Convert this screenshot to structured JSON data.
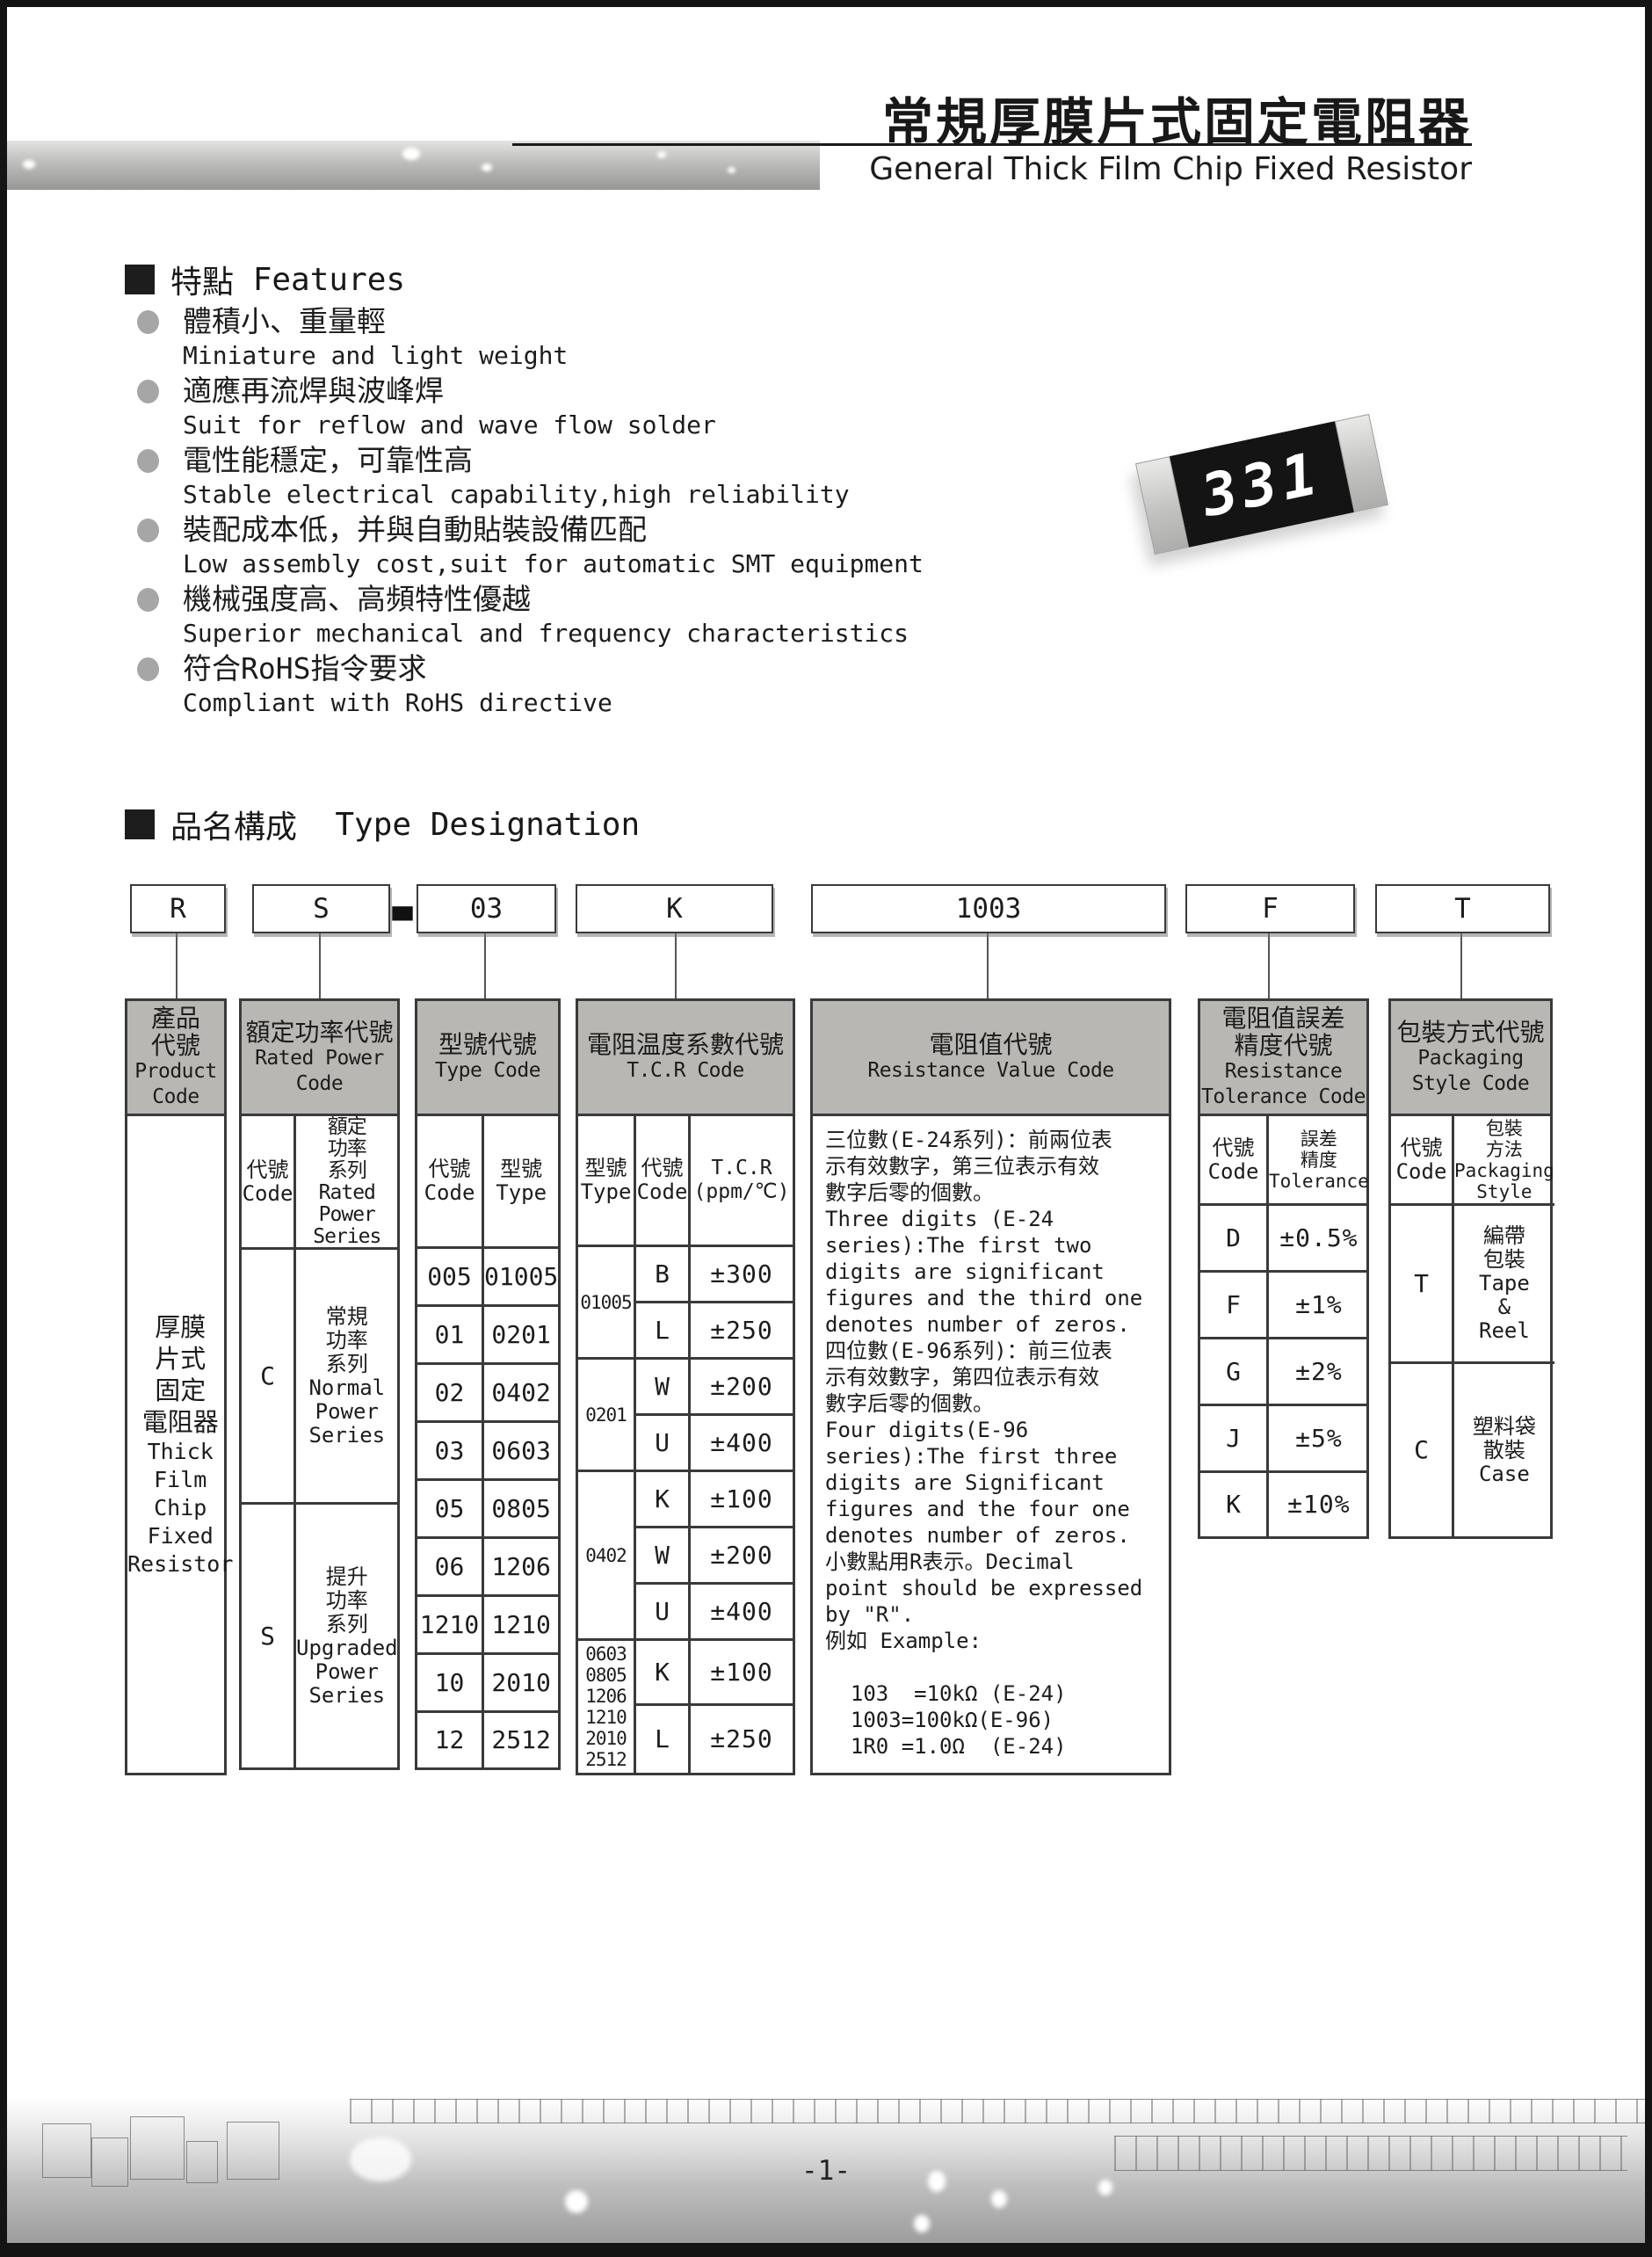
{
  "colors": {
    "header_fill": "#b8b7b3",
    "table_line": "#3a3a3a",
    "frame_black": "#141414",
    "bullet_gray": "#a6a6a6"
  },
  "header": {
    "title_cn": "常規厚膜片式固定電阻器",
    "title_en": "General Thick Film Chip Fixed Resistor"
  },
  "resistor_image": {
    "marking": "331"
  },
  "features": {
    "heading_cn": "特點",
    "heading_en": "Features",
    "items": [
      {
        "cn": "體積小、重量輕",
        "en": "Miniature and light weight"
      },
      {
        "cn": "適應再流焊與波峰焊",
        "en": "Suit for reflow and wave flow solder"
      },
      {
        "cn": "電性能穩定，可靠性高",
        "en": "Stable electrical capability,high reliability"
      },
      {
        "cn": "裝配成本低，并與自動貼裝設備匹配",
        "en": "Low assembly cost,suit for automatic SMT equipment"
      },
      {
        "cn": "機械强度高、高頻特性優越",
        "en": "Superior mechanical and frequency characteristics"
      },
      {
        "cn": "符合RoHS指令要求",
        "en": "Compliant with RoHS directive"
      }
    ]
  },
  "type_designation": {
    "heading_cn": "品名構成",
    "heading_en": "Type Designation",
    "codes": {
      "product": "R",
      "power": "S",
      "dash": "-",
      "type": "03",
      "tcr": "K",
      "resistance": "1003",
      "tolerance": "F",
      "packaging": "T"
    },
    "product_col": {
      "header_cn": "產品\n代號",
      "header_en": "Product\nCode",
      "body_cn": "厚膜\n片式\n固定\n電阻器",
      "body_en": "Thick\nFilm\nChip\nFixed\nResistor"
    },
    "power_col": {
      "header_cn": "額定功率代號",
      "header_en": "Rated Power\nCode",
      "sub_code": "代號\nCode",
      "sub_series": "額定\n功率\n系列\nRated\nPower\nSeries",
      "rows": [
        {
          "code": "C",
          "series": "常規\n功率\n系列\nNormal\nPower\nSeries"
        },
        {
          "code": "S",
          "series": "提升\n功率\n系列\nUpgraded\nPower\nSeries"
        }
      ]
    },
    "type_col": {
      "header_cn": "型號代號",
      "header_en": "Type Code",
      "sub_code": "代號\nCode",
      "sub_type": "型號\nType",
      "rows": [
        {
          "code": "005",
          "type": "01005"
        },
        {
          "code": "01",
          "type": "0201"
        },
        {
          "code": "02",
          "type": "0402"
        },
        {
          "code": "03",
          "type": "0603"
        },
        {
          "code": "05",
          "type": "0805"
        },
        {
          "code": "06",
          "type": "1206"
        },
        {
          "code": "1210",
          "type": "1210"
        },
        {
          "code": "10",
          "type": "2010"
        },
        {
          "code": "12",
          "type": "2512"
        }
      ]
    },
    "tcr_col": {
      "header_cn": "電阻温度系數代號",
      "header_en": "T.C.R Code",
      "sub_type": "型號\nType",
      "sub_code": "代號\nCode",
      "sub_tcr": "T.C.R\n(ppm/℃)",
      "groups": [
        {
          "type": "01005",
          "rows": [
            {
              "code": "B",
              "tcr": "±300"
            },
            {
              "code": "L",
              "tcr": "±250"
            }
          ]
        },
        {
          "type": "0201",
          "rows": [
            {
              "code": "W",
              "tcr": "±200"
            },
            {
              "code": "U",
              "tcr": "±400"
            }
          ]
        },
        {
          "type": "0402",
          "rows": [
            {
              "code": "K",
              "tcr": "±100"
            },
            {
              "code": "W",
              "tcr": "±200"
            },
            {
              "code": "U",
              "tcr": "±400"
            }
          ]
        },
        {
          "type": "0603\n0805\n1206\n1210\n2010\n2512",
          "rows": [
            {
              "code": "K",
              "tcr": "±100"
            },
            {
              "code": "L",
              "tcr": "±250"
            }
          ]
        }
      ]
    },
    "resistance_col": {
      "header_cn": "電阻值代號",
      "header_en": "Resistance Value Code",
      "body": "三位數(E-24系列)：前兩位表\n示有效數字，第三位表示有效\n數字后零的個數。\nThree digits (E-24\nseries):The first two\ndigits are significant\nfigures and the third one\ndenotes number of zeros.\n四位數(E-96系列)：前三位表\n示有效數字，第四位表示有效\n數字后零的個數。\nFour digits(E-96\nseries):The first three\ndigits are Significant\nfigures and the four one\ndenotes number of zeros.\n小數點用R表示。Decimal\npoint should be expressed\nby \"R\".\n例如 Example:\n\n  103  =10kΩ (E-24)\n  1003=100kΩ(E-96)\n  1R0 =1.0Ω  (E-24)"
    },
    "tolerance_col": {
      "header_cn": "電阻值誤差\n精度代號",
      "header_en": "Resistance\nTolerance Code",
      "sub_code": "代號\nCode",
      "sub_tol": "誤差\n精度\nTolerance",
      "rows": [
        {
          "code": "D",
          "tol": "±0.5%"
        },
        {
          "code": "F",
          "tol": "±1%"
        },
        {
          "code": "G",
          "tol": "±2%"
        },
        {
          "code": "J",
          "tol": "±5%"
        },
        {
          "code": "K",
          "tol": "±10%"
        }
      ]
    },
    "packaging_col": {
      "header_cn": "包裝方式代號",
      "header_en": "Packaging\nStyle Code",
      "sub_code": "代號\nCode",
      "sub_style": "包裝\n方法\nPackaging\nStyle",
      "rows": [
        {
          "code": "T",
          "style": "編帶\n包裝\nTape\n&\nReel"
        },
        {
          "code": "C",
          "style": "塑料袋\n散裝\nCase"
        }
      ]
    }
  },
  "footer": {
    "page_number": "-1-"
  }
}
